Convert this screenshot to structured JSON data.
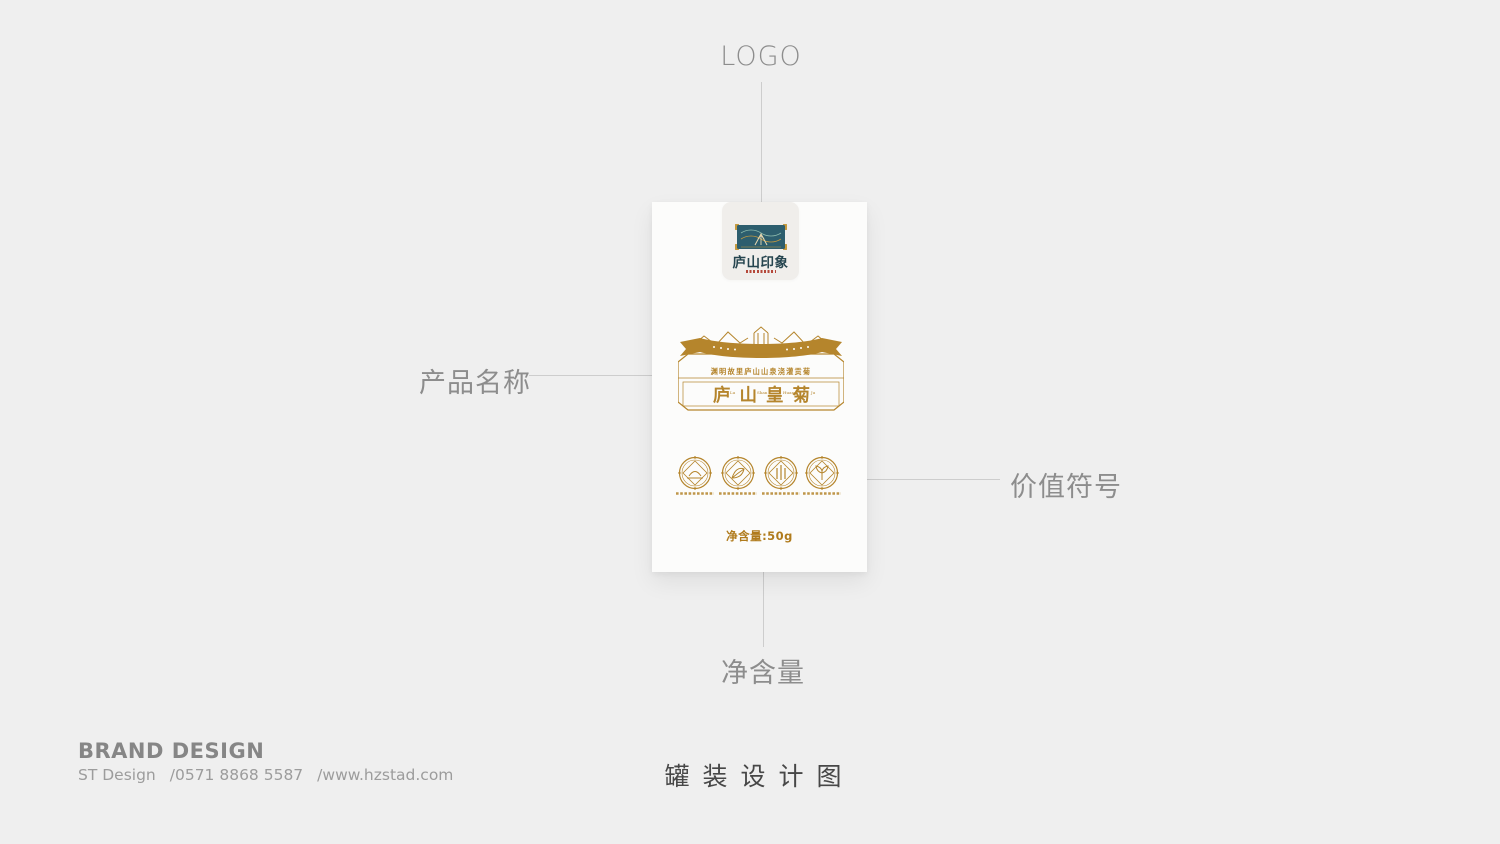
{
  "page": {
    "bg_color": "#efefef"
  },
  "callouts": {
    "logo": {
      "label": "LOGO"
    },
    "product_name": {
      "label": "产品名称"
    },
    "value_symbols": {
      "label": "价值符号"
    },
    "net_weight": {
      "label": "净含量"
    }
  },
  "package": {
    "logo_tab": {
      "emblem_icon": "mountain-gate-emblem",
      "brand_name": "庐山印象"
    },
    "name_plate": {
      "decor_icons": [
        "mountain-ridge-icon",
        "ribbon-banner-icon"
      ],
      "tagline": "渊明故里庐山山泉浇灌贡菊",
      "title": "庐山皇菊",
      "pinyin": [
        "Lu",
        "Shan",
        "Huang",
        "Ju"
      ]
    },
    "value_badges": [
      {
        "icon": "arch-seal-icon"
      },
      {
        "icon": "leaf-seal-icon"
      },
      {
        "icon": "bamboo-seal-icon"
      },
      {
        "icon": "sprout-seal-icon"
      }
    ],
    "net_weight_text": "净含量:50g"
  },
  "footer": {
    "title": "BRAND DESIGN",
    "studio": "ST Design",
    "phone": "/0571 8868 5587",
    "website": "/www.hzstad.com",
    "caption": "罐装设计图"
  },
  "colors": {
    "gold": "#b5852c",
    "gold_deep": "#b07b1c",
    "teal": "#2d5e6e",
    "calligraphy": "#26454f",
    "seal_red": "#b5483a",
    "label_gray": "#8d8d8d",
    "line_gray": "#cdcdcd",
    "caption_gray": "#474747"
  }
}
